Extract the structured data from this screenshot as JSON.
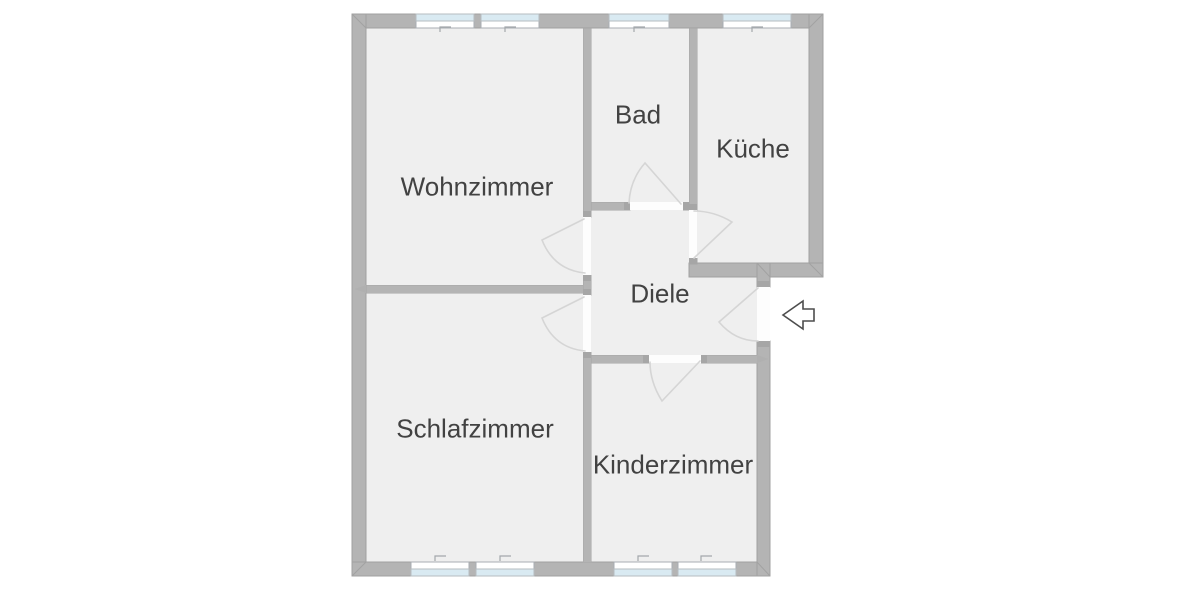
{
  "plan": {
    "type": "apartment-floor-plan",
    "rooms": [
      {
        "id": "wohnzimmer",
        "name": "Wohnzimmer"
      },
      {
        "id": "bad",
        "name": "Bad"
      },
      {
        "id": "kueche",
        "name": "Küche"
      },
      {
        "id": "diele",
        "name": "Diele"
      },
      {
        "id": "schlafzimmer",
        "name": "Schlafzimmer"
      },
      {
        "id": "kinderzimmer",
        "name": "Kinderzimmer"
      }
    ],
    "windows_top_count": 4,
    "windows_bottom_count": 4,
    "door_count": 6,
    "entrance": {
      "symbol": "arrow",
      "direction": "left"
    },
    "colors": {
      "background": "#ffffff",
      "wall": "#b4b4b4",
      "wall_edge": "#a1a1a1",
      "jamb_cap": "#a6a6a6",
      "floor": "#efefef",
      "door_opening": "#fdfdfd",
      "door_swing": "#d5d5d5",
      "window_glass": "#d9eaf2",
      "window_frame": "#a9aeb3",
      "window_mark": "#a3a8ac",
      "label_text": "#424242",
      "arrow_outline": "#4d4d4d"
    }
  }
}
